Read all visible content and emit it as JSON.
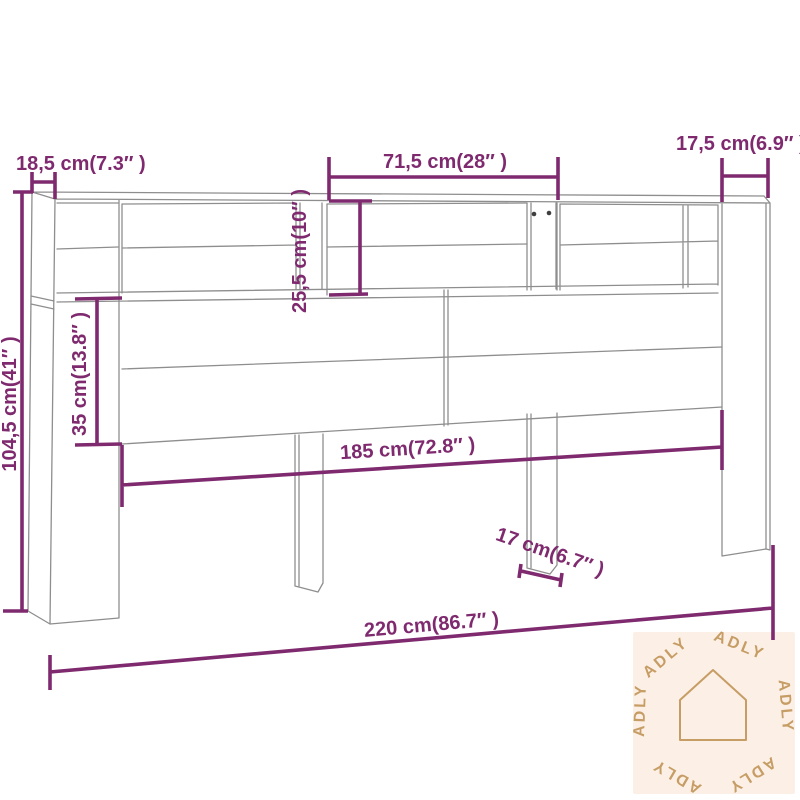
{
  "diagram": {
    "title": "headboard-cabinet-dimension-diagram",
    "dimensions": {
      "depth": {
        "label": "18,5 cm(7.3″ )",
        "cm": 18.5,
        "inch": 7.3
      },
      "middle_compartment_width": {
        "label": "71,5 cm(28″ )",
        "cm": 71.5,
        "inch": 28
      },
      "right_column_width": {
        "label": "17,5 cm(6.9″ )",
        "cm": 17.5,
        "inch": 6.9
      },
      "shelf_height": {
        "label": "25,5 cm(10″ )",
        "cm": 25.5,
        "inch": 10
      },
      "panel_height": {
        "label": "35 cm(13.8″ )",
        "cm": 35,
        "inch": 13.8
      },
      "overall_height": {
        "label": "104,5 cm(41″ )",
        "cm": 104.5,
        "inch": 41
      },
      "inner_width": {
        "label": "185 cm(72.8″ )",
        "cm": 185,
        "inch": 72.8
      },
      "leg_width": {
        "label": "17 cm(6.7″ )",
        "cm": 17,
        "inch": 6.7
      },
      "overall_width": {
        "label": "220 cm(86.7″ )",
        "cm": 220,
        "inch": 86.7
      }
    },
    "watermark": {
      "brand": "ADLY"
    },
    "colors": {
      "dimension": "#7f2a6f",
      "drawing_line": "#8e8e8e",
      "watermark_bg": "#fcf0e6",
      "watermark_fg": "#c79d66",
      "hole": "#3f3f3f",
      "background": "#ffffff"
    }
  }
}
